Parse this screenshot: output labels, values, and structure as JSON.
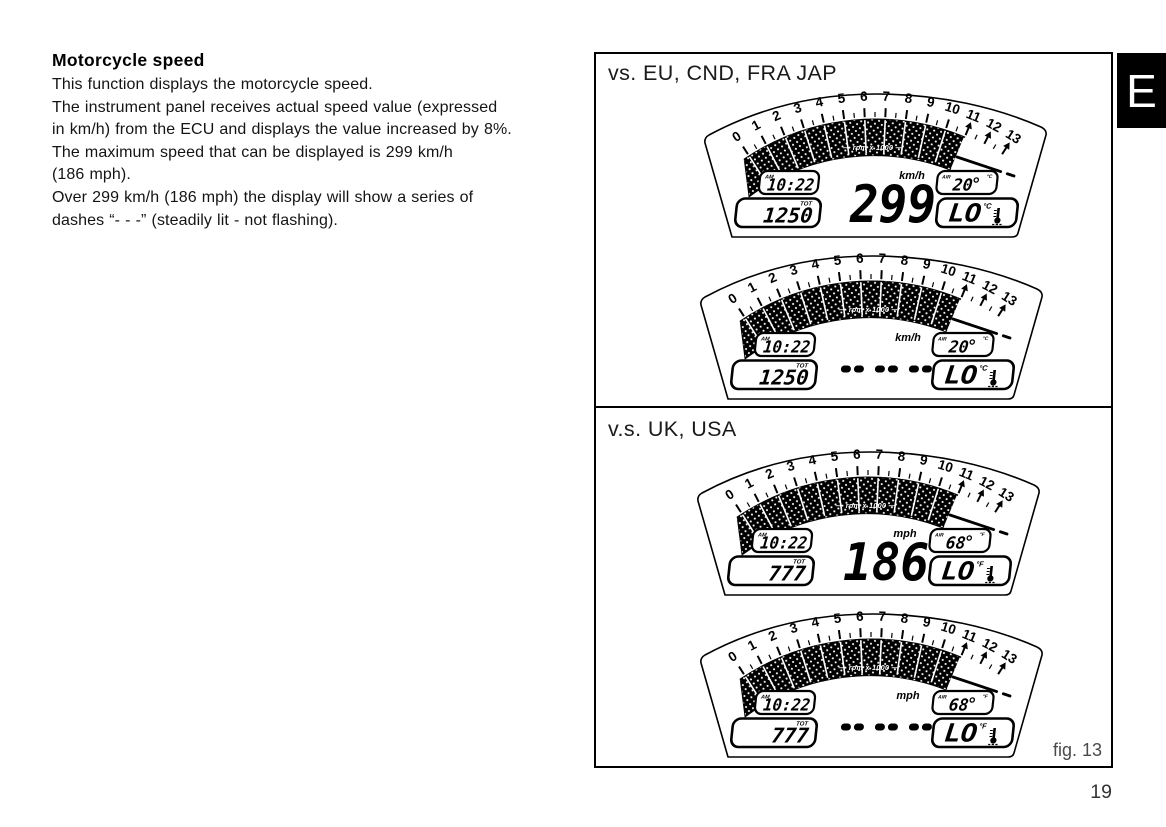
{
  "page": {
    "number": "19",
    "edition_tab": "E"
  },
  "article": {
    "title": "Motorcycle speed",
    "paragraphs": [
      "This function displays the motorcycle speed.",
      "The instrument panel receives actual speed value (expressed\nin km/h) from the ECU and displays the value increased by 8%.",
      "The maximum speed that can be displayed is 299 km/h\n(186 mph).",
      "Over 299 km/h (186 mph) the display will show a series of\ndashes “- - -” (steadily lit - not flashing)."
    ]
  },
  "figure": {
    "caption": "fig. 13",
    "sections": [
      {
        "label": "vs. EU, CND, FRA JAP",
        "gauges": [
          {
            "clock": "10:22",
            "meridiem": "AM",
            "odometer": "1250",
            "odometer_label": "TOT",
            "speed": "299",
            "speed_dashes": false,
            "speed_unit": "km/h",
            "air_label": "AIR",
            "air_temp": "20",
            "coolant_temp": "LO",
            "temp_unit": "°C",
            "tach": {
              "scale_min": 0,
              "scale_max": 13,
              "bars_filled_to": 11,
              "redline_marks": [
                11,
                12,
                13
              ],
              "scale_label": "rpm x 1000"
            }
          },
          {
            "clock": "10:22",
            "meridiem": "AM",
            "odometer": "1250",
            "odometer_label": "TOT",
            "speed": "- - -",
            "speed_dashes": true,
            "speed_unit": "km/h",
            "air_label": "AIR",
            "air_temp": "20",
            "coolant_temp": "LO",
            "temp_unit": "°C",
            "tach": {
              "scale_min": 0,
              "scale_max": 13,
              "bars_filled_to": 11,
              "redline_marks": [
                11,
                12,
                13
              ],
              "scale_label": "rpm x 1000"
            }
          }
        ]
      },
      {
        "label": "v.s. UK, USA",
        "gauges": [
          {
            "clock": "10:22",
            "meridiem": "AM",
            "odometer": "777",
            "odometer_label": "TOT",
            "speed": "186",
            "speed_dashes": false,
            "speed_unit": "mph",
            "air_label": "AIR",
            "air_temp": "68",
            "coolant_temp": "LO",
            "temp_unit": "°F",
            "tach": {
              "scale_min": 0,
              "scale_max": 13,
              "bars_filled_to": 11,
              "redline_marks": [
                11,
                12,
                13
              ],
              "scale_label": "rpm x 1000"
            }
          },
          {
            "clock": "10:22",
            "meridiem": "AM",
            "odometer": "777",
            "odometer_label": "TOT",
            "speed": "- - -",
            "speed_dashes": true,
            "speed_unit": "mph",
            "air_label": "AIR",
            "air_temp": "68",
            "coolant_temp": "LO",
            "temp_unit": "°F",
            "tach": {
              "scale_min": 0,
              "scale_max": 13,
              "bars_filled_to": 11,
              "redline_marks": [
                11,
                12,
                13
              ],
              "scale_label": "rpm x 1000"
            }
          }
        ]
      }
    ]
  }
}
